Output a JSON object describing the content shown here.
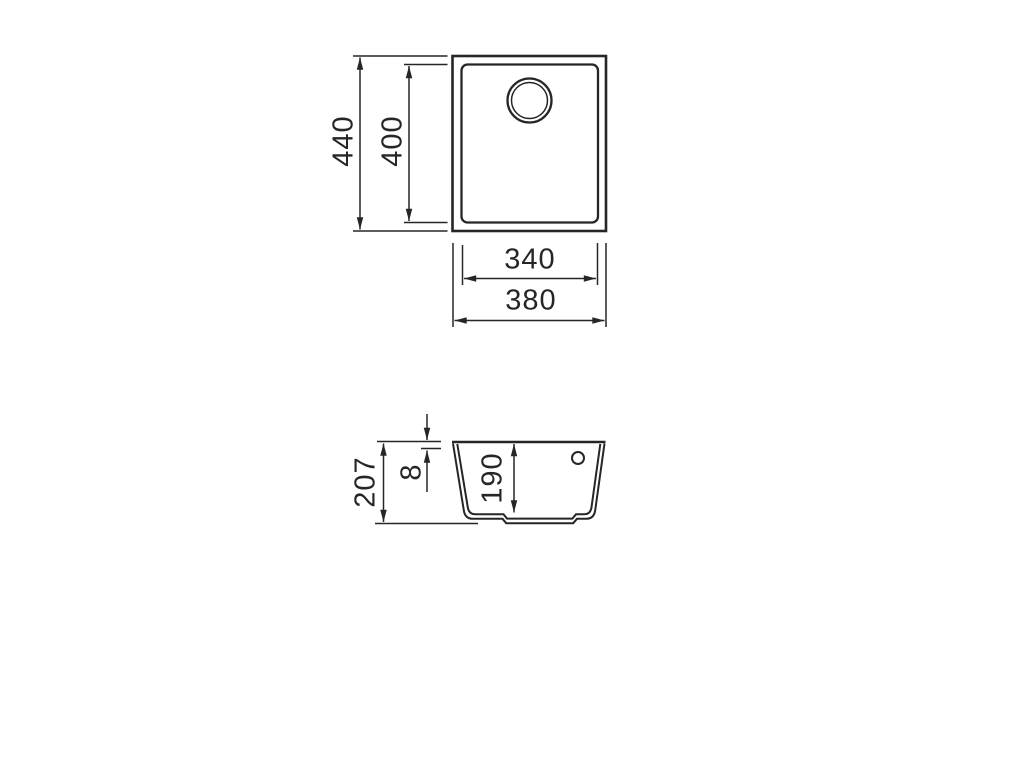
{
  "drawing": {
    "kind": "sink-technical-drawing",
    "background": "#ffffff",
    "line_color": "#262626",
    "views": {
      "top_view": {
        "name": "top-view",
        "dimensions": {
          "overall_height": "440",
          "inner_height": "400",
          "inner_width": "340",
          "overall_width": "380"
        }
      },
      "side_view": {
        "name": "side-section-view",
        "dimensions": {
          "overall_depth": "207",
          "rim_thickness": "8",
          "bowl_depth": "190"
        }
      }
    }
  }
}
